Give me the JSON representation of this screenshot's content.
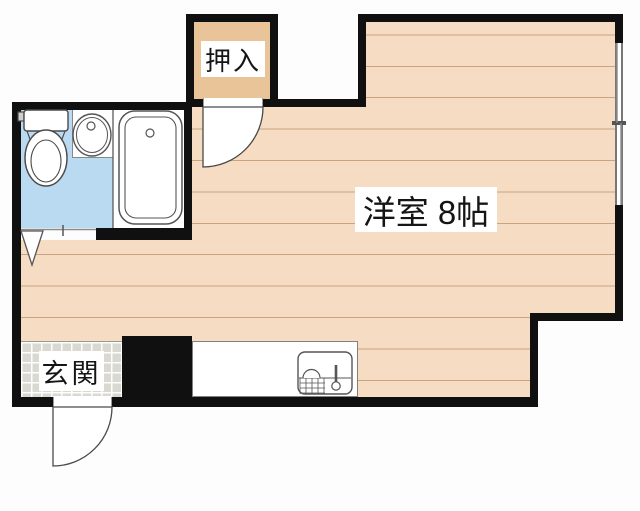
{
  "labels": {
    "closet": "押入",
    "main_room": "洋室 8帖",
    "entrance": "玄関"
  },
  "rooms": [
    {
      "name": "closet",
      "label": "押入"
    },
    {
      "name": "western-room-8-mats",
      "label": "洋室 8帖"
    },
    {
      "name": "entrance",
      "label": "玄関"
    },
    {
      "name": "bathroom",
      "label": ""
    }
  ],
  "fixtures": [
    "toilet-icon",
    "washbasin-icon",
    "bathtub-icon",
    "kitchen-sink-icon",
    "hinged-door-swing-icon",
    "folding-door-icon",
    "sliding-window-icon"
  ],
  "colors": {
    "background": "#fdfdfd",
    "wall": "#101010",
    "floor": "#f5dcc2",
    "floor_line": "#c9a47d",
    "closet_floor": "#e8c498",
    "bathroom_floor": "#badaf2",
    "entrance_tile": "#d9d9d1",
    "fixture_outline": "#555555",
    "label_bg": "#ffffff"
  }
}
